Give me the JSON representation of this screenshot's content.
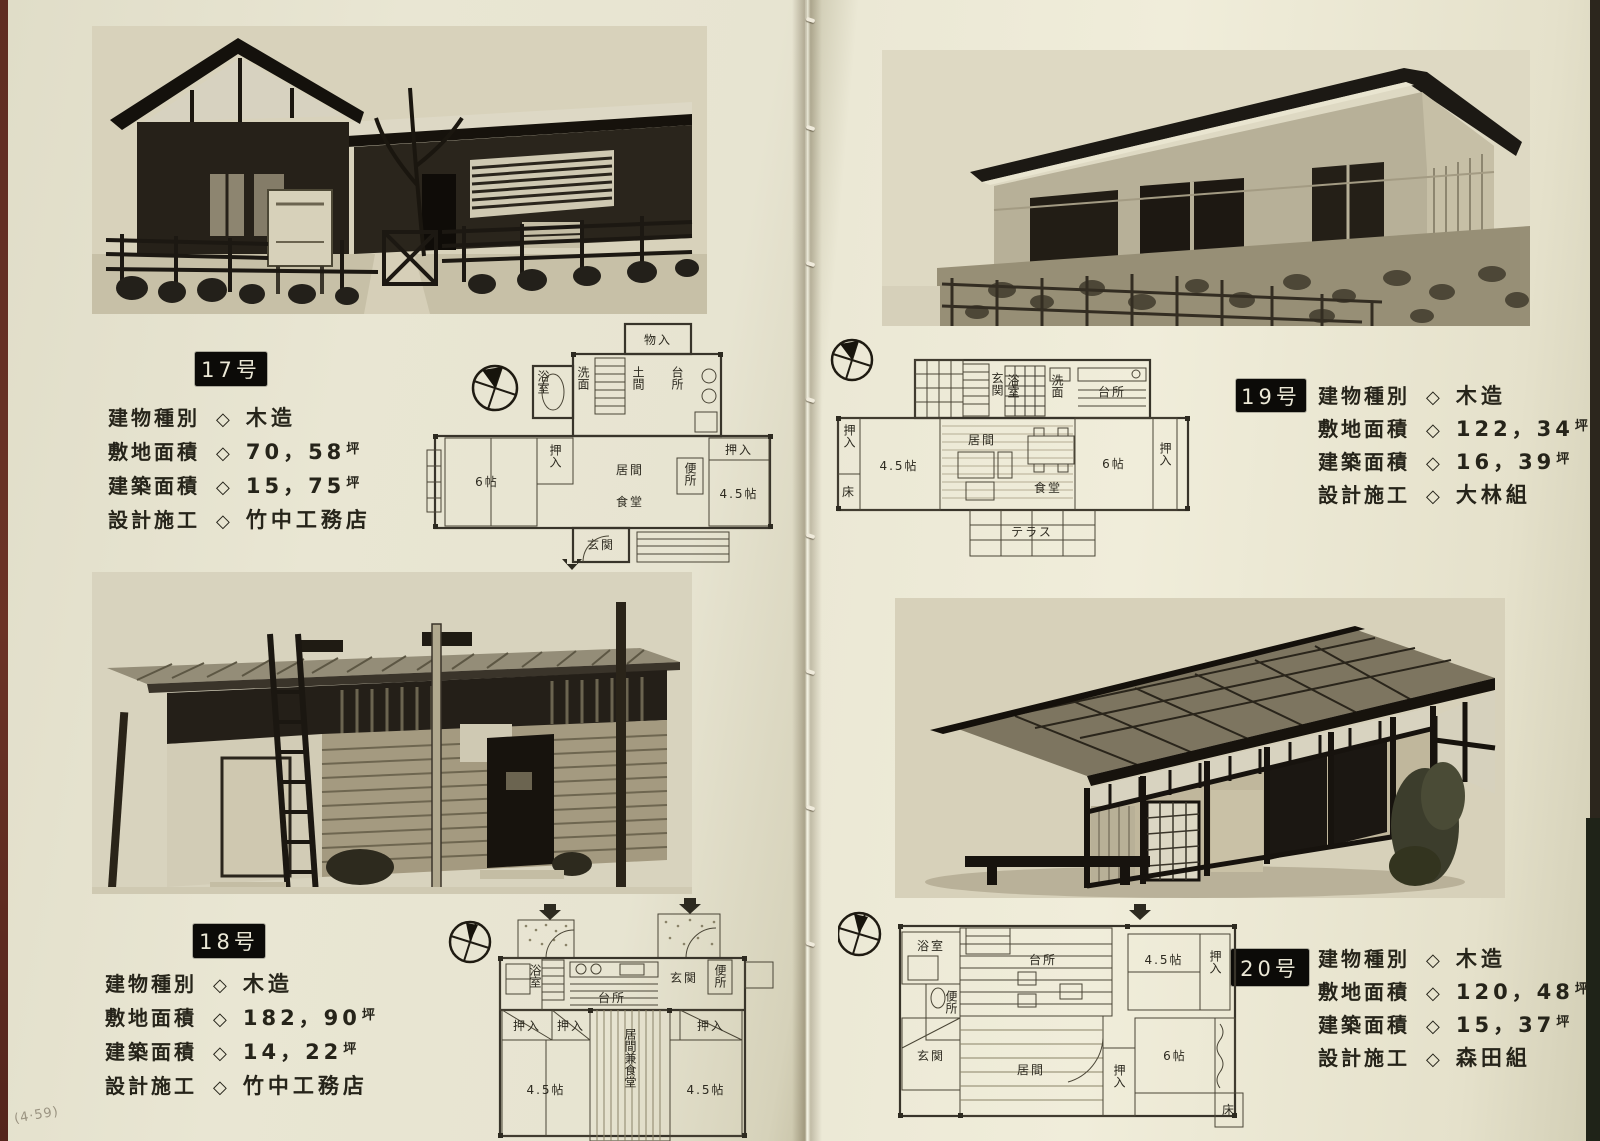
{
  "ui": {
    "diamond": "◇"
  },
  "annotations": {
    "pencil_note": "(4·59)"
  },
  "houses": [
    {
      "tag": "17号",
      "specs": [
        {
          "label": "建物種別",
          "value": "木造",
          "unit": ""
        },
        {
          "label": "敷地面積",
          "value": "70，58",
          "unit": "坪"
        },
        {
          "label": "建築面積",
          "value": "15，75",
          "unit": "坪"
        },
        {
          "label": "設計施工",
          "value": "竹中工務店",
          "unit": ""
        }
      ],
      "plan_rooms": [
        "物入",
        "洗面",
        "浴室",
        "土間",
        "台所",
        "便所",
        "押入",
        "押入",
        "6帖",
        "4.5帖",
        "居間",
        "食堂",
        "玄関"
      ]
    },
    {
      "tag": "18号",
      "specs": [
        {
          "label": "建物種別",
          "value": "木造",
          "unit": ""
        },
        {
          "label": "敷地面積",
          "value": "182，90",
          "unit": "坪"
        },
        {
          "label": "建築面積",
          "value": "14，22",
          "unit": "坪"
        },
        {
          "label": "設計施工",
          "value": "竹中工務店",
          "unit": ""
        }
      ],
      "plan_rooms": [
        "浴室",
        "台所",
        "玄関",
        "便所",
        "押入",
        "押入",
        "押入",
        "4.5帖",
        "4.5帖",
        "居間兼食堂"
      ]
    },
    {
      "tag": "19号",
      "specs": [
        {
          "label": "建物種別",
          "value": "木造",
          "unit": ""
        },
        {
          "label": "敷地面積",
          "value": "122，34",
          "unit": "坪"
        },
        {
          "label": "建築面積",
          "value": "16，39",
          "unit": "坪"
        },
        {
          "label": "設計施工",
          "value": "大林組",
          "unit": ""
        }
      ],
      "plan_rooms": [
        "玄関",
        "浴室",
        "洗面",
        "台所",
        "押入",
        "床",
        "4.5帖",
        "居間",
        "食堂",
        "6帖",
        "押入",
        "テラス"
      ]
    },
    {
      "tag": "20号",
      "specs": [
        {
          "label": "建物種別",
          "value": "木造",
          "unit": ""
        },
        {
          "label": "敷地面積",
          "value": "120，48",
          "unit": "坪"
        },
        {
          "label": "建築面積",
          "value": "15，37",
          "unit": "坪"
        },
        {
          "label": "設計施工",
          "value": "森田組",
          "unit": ""
        }
      ],
      "plan_rooms": [
        "浴室",
        "便所",
        "台所",
        "4.5帖",
        "押入",
        "玄関",
        "居間",
        "6帖",
        "押入",
        "床"
      ]
    }
  ]
}
